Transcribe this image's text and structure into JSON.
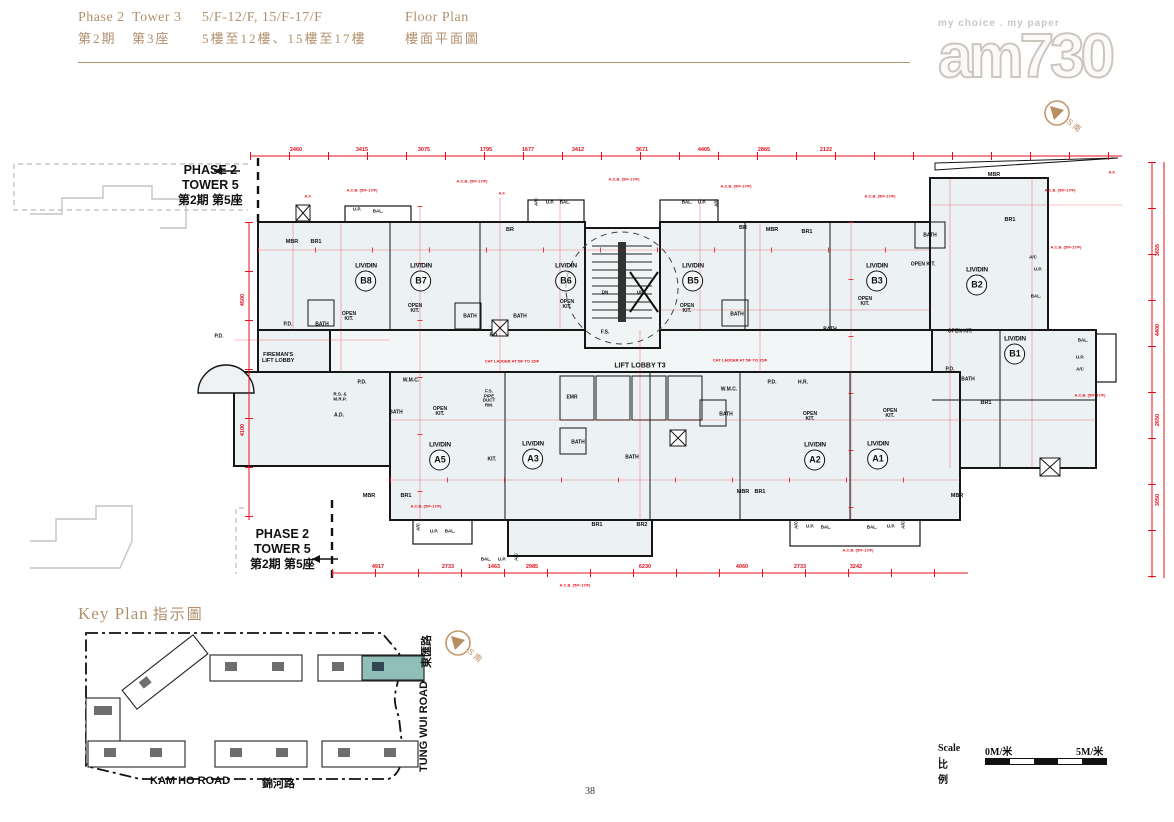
{
  "header": {
    "en_phase": "Phase 2",
    "en_tower": "Tower 3",
    "zh_phase": "第2期",
    "zh_tower": "第3座",
    "en_floors": "5/F-12/F, 15/F-17/F",
    "zh_floors": "5樓至12樓、15樓至17樓",
    "en_plan": "Floor Plan",
    "zh_plan": "樓面平面圖"
  },
  "logo": {
    "tagline": "my choice . my paper",
    "name": "am730"
  },
  "compass_label": "S 南",
  "plan": {
    "note_top": {
      "l1": "PHASE 2",
      "l2": "TOWER  5",
      "l3": "第2期 第5座"
    },
    "note_bottom": {
      "l1": "PHASE 2",
      "l2": "TOWER  5",
      "l3": "第2期 第5座"
    },
    "lobby": "LIFT LOBBY T3",
    "fireman": "FIREMAN'S\nLIFT LOBBY",
    "unit_label": "LIV/DIN",
    "units": [
      {
        "id": "B8",
        "x": 366,
        "y": 277
      },
      {
        "id": "B7",
        "x": 421,
        "y": 277
      },
      {
        "id": "B6",
        "x": 566,
        "y": 277
      },
      {
        "id": "B5",
        "x": 693,
        "y": 277
      },
      {
        "id": "B3",
        "x": 877,
        "y": 277
      },
      {
        "id": "B2",
        "x": 977,
        "y": 281
      },
      {
        "id": "B1",
        "x": 1015,
        "y": 350
      },
      {
        "id": "A5",
        "x": 440,
        "y": 456
      },
      {
        "id": "A3",
        "x": 533,
        "y": 455
      },
      {
        "id": "A2",
        "x": 815,
        "y": 456
      },
      {
        "id": "A1",
        "x": 878,
        "y": 455
      }
    ],
    "rooms": [
      {
        "t": "MBR",
        "x": 292,
        "y": 243
      },
      {
        "t": "BR1",
        "x": 316,
        "y": 243
      },
      {
        "t": "BR",
        "x": 510,
        "y": 231
      },
      {
        "t": "BR",
        "x": 743,
        "y": 229
      },
      {
        "t": "MBR",
        "x": 772,
        "y": 231
      },
      {
        "t": "BR1",
        "x": 807,
        "y": 233
      },
      {
        "t": "MBR",
        "x": 994,
        "y": 176
      },
      {
        "t": "BR1",
        "x": 1010,
        "y": 221
      },
      {
        "t": "BR1",
        "x": 986,
        "y": 404
      },
      {
        "t": "BATH",
        "x": 322,
        "y": 325,
        "s": 5
      },
      {
        "t": "BATH",
        "x": 470,
        "y": 317,
        "s": 5
      },
      {
        "t": "BATH",
        "x": 520,
        "y": 317,
        "s": 5
      },
      {
        "t": "BATH",
        "x": 737,
        "y": 315,
        "s": 5
      },
      {
        "t": "BATH",
        "x": 830,
        "y": 330,
        "s": 5
      },
      {
        "t": "BATH",
        "x": 930,
        "y": 236,
        "s": 5
      },
      {
        "t": "BATH",
        "x": 968,
        "y": 380,
        "s": 5
      },
      {
        "t": "BATH",
        "x": 578,
        "y": 443,
        "s": 5
      },
      {
        "t": "BATH",
        "x": 632,
        "y": 458,
        "s": 5
      },
      {
        "t": "BATH",
        "x": 396,
        "y": 413,
        "s": 5
      },
      {
        "t": "BATH",
        "x": 726,
        "y": 415,
        "s": 5
      },
      {
        "t": "OPEN\nKIT.",
        "x": 349,
        "y": 317,
        "s": 5
      },
      {
        "t": "OPEN\nKIT.",
        "x": 415,
        "y": 309,
        "s": 5
      },
      {
        "t": "OPEN\nKIT.",
        "x": 567,
        "y": 305,
        "s": 5
      },
      {
        "t": "OPEN\nKIT.",
        "x": 687,
        "y": 309,
        "s": 5
      },
      {
        "t": "OPEN\nKIT.",
        "x": 865,
        "y": 302,
        "s": 5
      },
      {
        "t": "OPEN KIT.",
        "x": 923,
        "y": 265,
        "s": 5
      },
      {
        "t": "OPEN KIT.",
        "x": 960,
        "y": 332,
        "s": 5
      },
      {
        "t": "OPEN\nKIT.",
        "x": 440,
        "y": 412,
        "s": 5
      },
      {
        "t": "OPEN\nKIT.",
        "x": 810,
        "y": 417,
        "s": 5
      },
      {
        "t": "OPEN\nKIT.",
        "x": 890,
        "y": 414,
        "s": 5
      },
      {
        "t": "KIT.",
        "x": 492,
        "y": 460,
        "s": 5
      },
      {
        "t": "P.D.",
        "x": 219,
        "y": 337,
        "s": 5
      },
      {
        "t": "P.D.",
        "x": 288,
        "y": 325,
        "s": 5
      },
      {
        "t": "P.D.",
        "x": 494,
        "y": 336,
        "s": 5
      },
      {
        "t": "P.D.",
        "x": 772,
        "y": 383,
        "s": 5
      },
      {
        "t": "P.D.",
        "x": 950,
        "y": 370,
        "s": 5
      },
      {
        "t": "P.D.",
        "x": 362,
        "y": 383,
        "s": 5
      },
      {
        "t": "H.R.",
        "x": 803,
        "y": 383,
        "s": 5
      },
      {
        "t": "F.S.",
        "x": 605,
        "y": 333,
        "s": 5
      },
      {
        "t": "EMR",
        "x": 572,
        "y": 398,
        "s": 5
      },
      {
        "t": "W.M.C.",
        "x": 411,
        "y": 381,
        "s": 5
      },
      {
        "t": "W.M.C.",
        "x": 729,
        "y": 390,
        "s": 5
      },
      {
        "t": "F.S.\nPIPE\nDUCT\nRM.",
        "x": 489,
        "y": 399,
        "s": 4.5
      },
      {
        "t": "R.S. &\nM.R.P.",
        "x": 340,
        "y": 397,
        "s": 4.5
      },
      {
        "t": "A.D.",
        "x": 339,
        "y": 416,
        "s": 5
      },
      {
        "t": "U.P.",
        "x": 357,
        "y": 210,
        "s": 4.5
      },
      {
        "t": "BAL.",
        "x": 378,
        "y": 212,
        "s": 4.5
      },
      {
        "t": "A/C",
        "x": 537,
        "y": 202,
        "s": 4.5,
        "r": -90
      },
      {
        "t": "U.P.",
        "x": 550,
        "y": 203,
        "s": 4.5
      },
      {
        "t": "BAL.",
        "x": 565,
        "y": 203,
        "s": 4.5
      },
      {
        "t": "BAL.",
        "x": 687,
        "y": 203,
        "s": 4.5
      },
      {
        "t": "U.P.",
        "x": 702,
        "y": 203,
        "s": 4.5
      },
      {
        "t": "A/C",
        "x": 717,
        "y": 203,
        "s": 4.5,
        "r": -90
      },
      {
        "t": "A/C",
        "x": 1033,
        "y": 258,
        "s": 4.5
      },
      {
        "t": "U.P.",
        "x": 1038,
        "y": 270,
        "s": 4.5
      },
      {
        "t": "BAL.",
        "x": 1036,
        "y": 297,
        "s": 4.5
      },
      {
        "t": "BAL.",
        "x": 1083,
        "y": 341,
        "s": 4.5
      },
      {
        "t": "U.P.",
        "x": 1080,
        "y": 358,
        "s": 4.5
      },
      {
        "t": "A/C",
        "x": 1080,
        "y": 370,
        "s": 4.5
      },
      {
        "t": "A/C",
        "x": 419,
        "y": 527,
        "s": 4.5,
        "r": -90
      },
      {
        "t": "U.P.",
        "x": 434,
        "y": 532,
        "s": 4.5
      },
      {
        "t": "BAL.",
        "x": 450,
        "y": 532,
        "s": 4.5
      },
      {
        "t": "BAL.",
        "x": 486,
        "y": 560,
        "s": 4.5
      },
      {
        "t": "U.P.",
        "x": 502,
        "y": 560,
        "s": 4.5
      },
      {
        "t": "A/C",
        "x": 517,
        "y": 557,
        "s": 4.5,
        "r": -90
      },
      {
        "t": "A/C",
        "x": 797,
        "y": 525,
        "s": 4.5,
        "r": -90
      },
      {
        "t": "U.P.",
        "x": 810,
        "y": 527,
        "s": 4.5
      },
      {
        "t": "BAL.",
        "x": 826,
        "y": 528,
        "s": 4.5
      },
      {
        "t": "BAL.",
        "x": 872,
        "y": 528,
        "s": 4.5
      },
      {
        "t": "U.P.",
        "x": 891,
        "y": 527,
        "s": 4.5
      },
      {
        "t": "A/C",
        "x": 904,
        "y": 525,
        "s": 4.5,
        "r": -90
      },
      {
        "t": "MBR",
        "x": 369,
        "y": 497
      },
      {
        "t": "BR1",
        "x": 406,
        "y": 497
      },
      {
        "t": "BR1",
        "x": 597,
        "y": 526
      },
      {
        "t": "BR2",
        "x": 642,
        "y": 526
      },
      {
        "t": "MBR",
        "x": 743,
        "y": 493
      },
      {
        "t": "BR1",
        "x": 760,
        "y": 493
      },
      {
        "t": "MBR",
        "x": 957,
        "y": 497
      },
      {
        "t": "DN",
        "x": 605,
        "y": 293,
        "s": 4.5
      },
      {
        "t": "UP",
        "x": 640,
        "y": 293,
        "s": 4.5
      }
    ],
    "red_notes": [
      {
        "t": "A.C.B. (5/F-17/F)",
        "x": 362,
        "y": 190
      },
      {
        "t": "A.C.B. (5/F-17/F)",
        "x": 472,
        "y": 181
      },
      {
        "t": "A.C.B. (5/F-17/F)",
        "x": 624,
        "y": 179
      },
      {
        "t": "A.C.B. (5/F-17/F)",
        "x": 736,
        "y": 186
      },
      {
        "t": "A.C.B. (5/F-17/F)",
        "x": 880,
        "y": 196
      },
      {
        "t": "A.C.B. (5/F-17/F)",
        "x": 1060,
        "y": 190
      },
      {
        "t": "A.C.B. (5/F-17/F)",
        "x": 1066,
        "y": 247
      },
      {
        "t": "A.C.B. (5/F-17/F)",
        "x": 1090,
        "y": 395
      },
      {
        "t": "A.C.B. (5/F-17/F)",
        "x": 426,
        "y": 506
      },
      {
        "t": "A.C.B. (5/F-17/F)",
        "x": 575,
        "y": 585
      },
      {
        "t": "A.C.B. (5/F-17/F)",
        "x": 858,
        "y": 550
      },
      {
        "t": "A.F.",
        "x": 308,
        "y": 196
      },
      {
        "t": "A.F.",
        "x": 502,
        "y": 193
      },
      {
        "t": "A.F.",
        "x": 1112,
        "y": 172
      },
      {
        "t": "CAT LADDER AT 5/F TO 15/F",
        "x": 512,
        "y": 361
      },
      {
        "t": "CAT LADDER AT 5/F TO 15/F",
        "x": 740,
        "y": 360
      }
    ],
    "dims_top": [
      {
        "v": "2460",
        "x": 296
      },
      {
        "v": "3415",
        "x": 362
      },
      {
        "v": "3075",
        "x": 424
      },
      {
        "v": "1795",
        "x": 486
      },
      {
        "v": "1677",
        "x": 528
      },
      {
        "v": "3412",
        "x": 578
      },
      {
        "v": "3671",
        "x": 642
      },
      {
        "v": "4405",
        "x": 704
      },
      {
        "v": "2865",
        "x": 764
      },
      {
        "v": "2122",
        "x": 826
      }
    ],
    "dims_bottom": [
      {
        "v": "4917",
        "x": 378
      },
      {
        "v": "2733",
        "x": 448
      },
      {
        "v": "1463",
        "x": 494
      },
      {
        "v": "2985",
        "x": 532
      },
      {
        "v": "6230",
        "x": 645
      },
      {
        "v": "4060",
        "x": 742
      },
      {
        "v": "2733",
        "x": 800
      },
      {
        "v": "3242",
        "x": 856
      }
    ],
    "dims_left": [
      {
        "v": "4500",
        "y": 300
      },
      {
        "v": "4100",
        "y": 430
      }
    ],
    "dims_right": [
      {
        "v": "3655",
        "y": 250
      },
      {
        "v": "4400",
        "y": 330
      },
      {
        "v": "2650",
        "y": 420
      },
      {
        "v": "3050",
        "y": 500
      }
    ]
  },
  "key_plan": {
    "title_en": "Key Plan",
    "title_zh": "指示圖",
    "road_kam_en": "KAM HO ROAD",
    "road_kam_zh": "錦河路",
    "road_tung_en": "TUNG WUI ROAD",
    "road_tung_zh": "東匯路"
  },
  "scale_bar": {
    "label_en": "Scale :",
    "label_zh": "比例",
    "from": "0M/米",
    "to": "5M/米"
  },
  "page_number": "38",
  "colors": {
    "accent": "#b2906e",
    "red": "#e4101e",
    "teal": "#8fbfb8",
    "plan_fill": "#ecf1f3"
  }
}
